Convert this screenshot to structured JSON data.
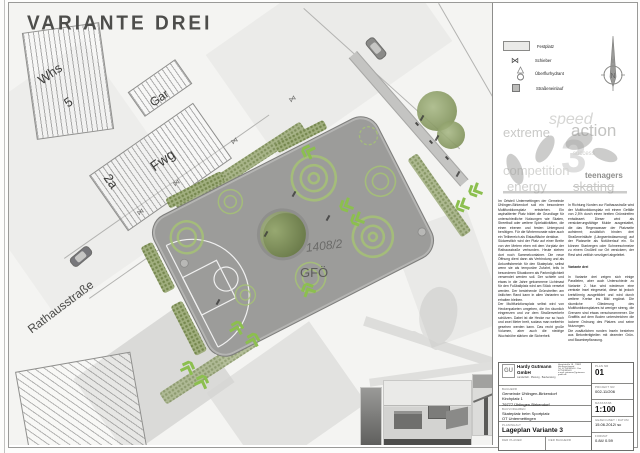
{
  "title": "VARIANTE DREI",
  "plan": {
    "labels": {
      "whs": "Whs",
      "whs_no": "5",
      "gar": "Gar",
      "fwg": "Fwg",
      "haus_no": "2a",
      "street": "Rathausstraße",
      "parcel": "1408/2",
      "area_code": "GFÖ"
    }
  },
  "legend": {
    "items": [
      {
        "label": "Festplatz"
      },
      {
        "label": "Schieber",
        "glyph": "⋈"
      },
      {
        "label": "Überflurhydrant"
      },
      {
        "label": "Straßeneinlauf"
      }
    ]
  },
  "north": {
    "letter": "N"
  },
  "logo_cloud": {
    "words": [
      "extreme",
      "speed",
      "action",
      "3",
      "success",
      "competition",
      "teenagers",
      "energy",
      "skating"
    ]
  },
  "panel_text": {
    "column1": "Im Ortsteil Untermettingen der Gemeinde Ühlingen-Birkendorf soll ein besonderer Multifunktionsplatz entstehen. Ein asphaltierter Platz bildet die Grundlage für unterschiedliche Nutzungen wie Skaten, Streetball oder weitere Spielaktivitäten, die einen ebenen und festen Untergrund benötigen. Für die Wintermonate wäre auch ein Teilbereich als Eislauffläche denkbar.\nSüdwestlich wird der Platz auf einer Breite von vier Metern eben mit dem Vorplatz der Rathausstraße verbunden. Heute stehen dort noch Sammelcontainer. Die neue Öffnung dient dann als Verbindung und als Ankunftsbereich für den Skateplatz, selbst wenn sie als temporäre Zufahrt, teils in besonderen Situationen als Parkmöglichkeit verwendet werden soll. Der schiefe und etwas in die Jahre gekommene Lichtmast für den Fußballplatz wird am Stück versetzt werden. Der bestehende Grünstreifen am östlichen Rand kann in allen Varianten so erhalten bleiben.\nDer Multifunktionsplatz selbst wird von Heckenpaketen umgeben, die ihn räumlich eingrenzen und vor dem Straßenverkehr schützen. Dabei ist die Hecke nur so hoch und zwei Meter breit, sodass man weiterhin gesehen werden kann. Das recht große Volumen, aber auch die niedrige Wuchshöhe stärken die Sicherheit.",
    "column2_intro": "In Richtung Norden zur Rathausstraße wird der Multifunktionsplatz mit einem Gefälle von 2,5% durch einen breiten Grünstreifen entwässert. Dieser wird als versickerungsfähige Mulde ausgestattet, die das Regenwasser der Platzseite aufnimmt; zusätzlich binden drei Straßeneinläufe (Längsentwässerung) auf der Platzseite als Notüberlauf ein. So können Starkregen oder Schneeschmelze zu einem Großteil vor Ort versickern, der Rest wird zeitlich verzögert abgeleitet.",
    "column2_heading": "Variante drei",
    "column2_body": "In Variante drei zeigen sich einige Parallelen, aber auch Unterschiede zu Variante 2. Nun wird wiederum eine zentrale Insel eingesetzt, diese ist jedoch kreisförmig ausgebildet und wird durch weitere Kreise ins Bild ergänzt. Die räumliche Gliederung des Multifunktionsplatzes ist weniger streng, die Grenzen sind etwas verschwommener. Die Graffitis auf dem Boden unterstreichen die lockere Ordnung des Platzes und seine Nutzungen.\nDie zusätzlichen runden Inseln bestehen aus Betonfertigteilen mit dezenter Grün- und Baumbepflanzung."
  },
  "titleblock": {
    "firm": {
      "initials": "GU",
      "name": "Hardy Gutmann GmbH",
      "tagline": "Landschaft · Planung · Bauberatung",
      "address": "Hauptstraße 18 · 79862 Höchenschwand",
      "contact": "Tel. 07755/9394-0 · Fax 07755/9394-9",
      "email": "e-mail: gutmann@gutmann-gmbh.de"
    },
    "bauherr_label": "BAUHERR",
    "bauherr_line1": "Gemeinde Ühlingen-Birkendorf",
    "bauherr_line2": "Kirchplatz 1",
    "bauherr_line3": "79777 Ühlingen-Birkendorf",
    "bauvorhaben_label": "BAUVORHABEN",
    "bauvorhaben_line1": "Skateplatz beim Sportplatz",
    "bauvorhaben_line2": "OT Untermettingen",
    "planinhalt_label": "PLANINHALT",
    "planinhalt_value": "Lageplan  Variante 3",
    "plan_nr_label": "PLAN NR",
    "plan_nr": "01",
    "projekt_nr_label": "PROJEKT NR",
    "projekt_nr": "002-11/206",
    "massstab_label": "MASSSTAB",
    "massstab": "1:100",
    "gezeichnet_label": "GEZEICHNET / DATUM",
    "gezeichnet": "15.06.2012/ sc",
    "format_label": "FORMAT",
    "format": "0.84/ 0.59",
    "planer_label": "DER PLANER",
    "bauherr_sig_label": "DER BAUHERR"
  }
}
